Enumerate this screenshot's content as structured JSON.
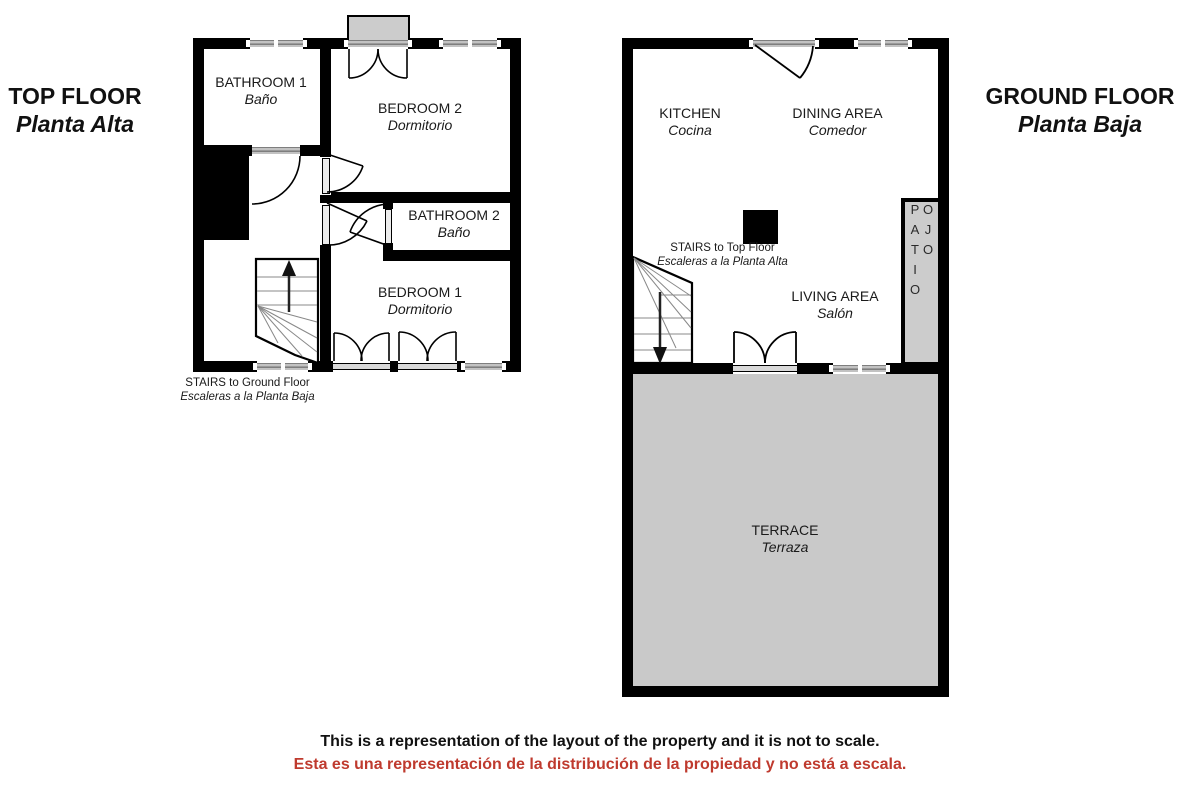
{
  "titles": {
    "top_floor": {
      "en": "TOP FLOOR",
      "es": "Planta Alta"
    },
    "ground_floor": {
      "en": "GROUND FLOOR",
      "es": "Planta Baja"
    }
  },
  "top_floor": {
    "bathroom1": {
      "en": "BATHROOM 1",
      "es": "Baño"
    },
    "bedroom2": {
      "en": "BEDROOM 2",
      "es": "Dormitorio"
    },
    "bathroom2": {
      "en": "BATHROOM 2",
      "es": "Baño"
    },
    "bedroom1": {
      "en": "BEDROOM 1",
      "es": "Dormitorio"
    },
    "stairs": {
      "en": "STAIRS to Ground Floor",
      "es": "Escaleras a la Planta Baja"
    }
  },
  "ground_floor": {
    "kitchen": {
      "en": "KITCHEN",
      "es": "Cocina"
    },
    "dining": {
      "en": "DINING AREA",
      "es": "Comedor"
    },
    "living": {
      "en": "LIVING AREA",
      "es": "Salón"
    },
    "terrace": {
      "en": "TERRACE",
      "es": "Terraza"
    },
    "patio": {
      "label": "OJO PATIO"
    },
    "stairs": {
      "en": "STAIRS to Top Floor",
      "es": "Escaleras a la Planta Alta"
    }
  },
  "footer": {
    "en": "This is a representation of the layout of the property and it is not to scale.",
    "es": "Esta es una representación de la distribución de la propiedad y no está a escala."
  },
  "colors": {
    "wall": "#000000",
    "area_gray": "#c9c9c9",
    "window_gray": "#9a9a9a",
    "footer_red": "#bf3a2e"
  }
}
